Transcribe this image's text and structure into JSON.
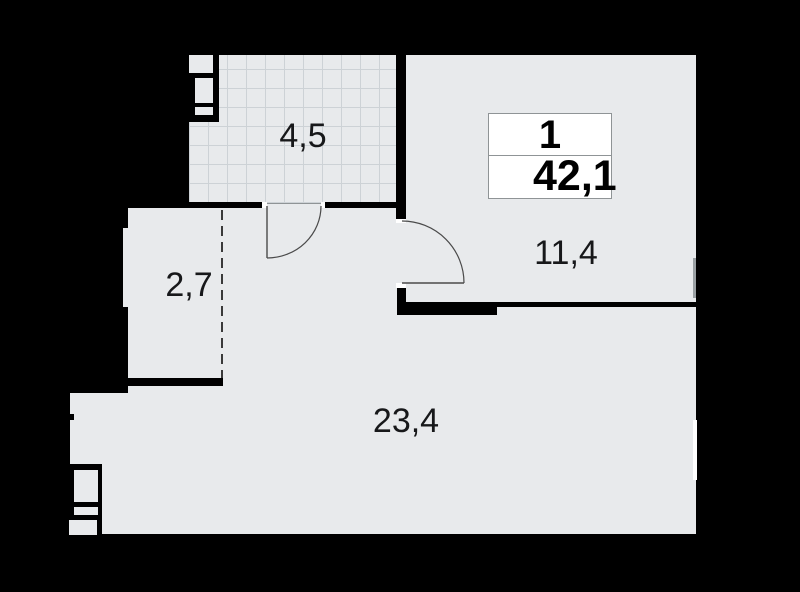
{
  "summary": {
    "rooms_count": "1",
    "total_area": "42,1"
  },
  "rooms": {
    "balcony": {
      "area": "4,5"
    },
    "main_room": {
      "area": "11,4"
    },
    "hall": {
      "area": "2,7"
    },
    "living_kitchen": {
      "area": "23,4"
    }
  },
  "colors": {
    "background": "#000000",
    "wall": "#000000",
    "floor": "#e8eaec",
    "hatch-line": "#cdd2d6",
    "door-line": "#4a4a4a",
    "box-border": "#8f9496",
    "label": "#17181a",
    "infobox-bg": "#ffffff",
    "window-gray": "#9aa0a3"
  }
}
